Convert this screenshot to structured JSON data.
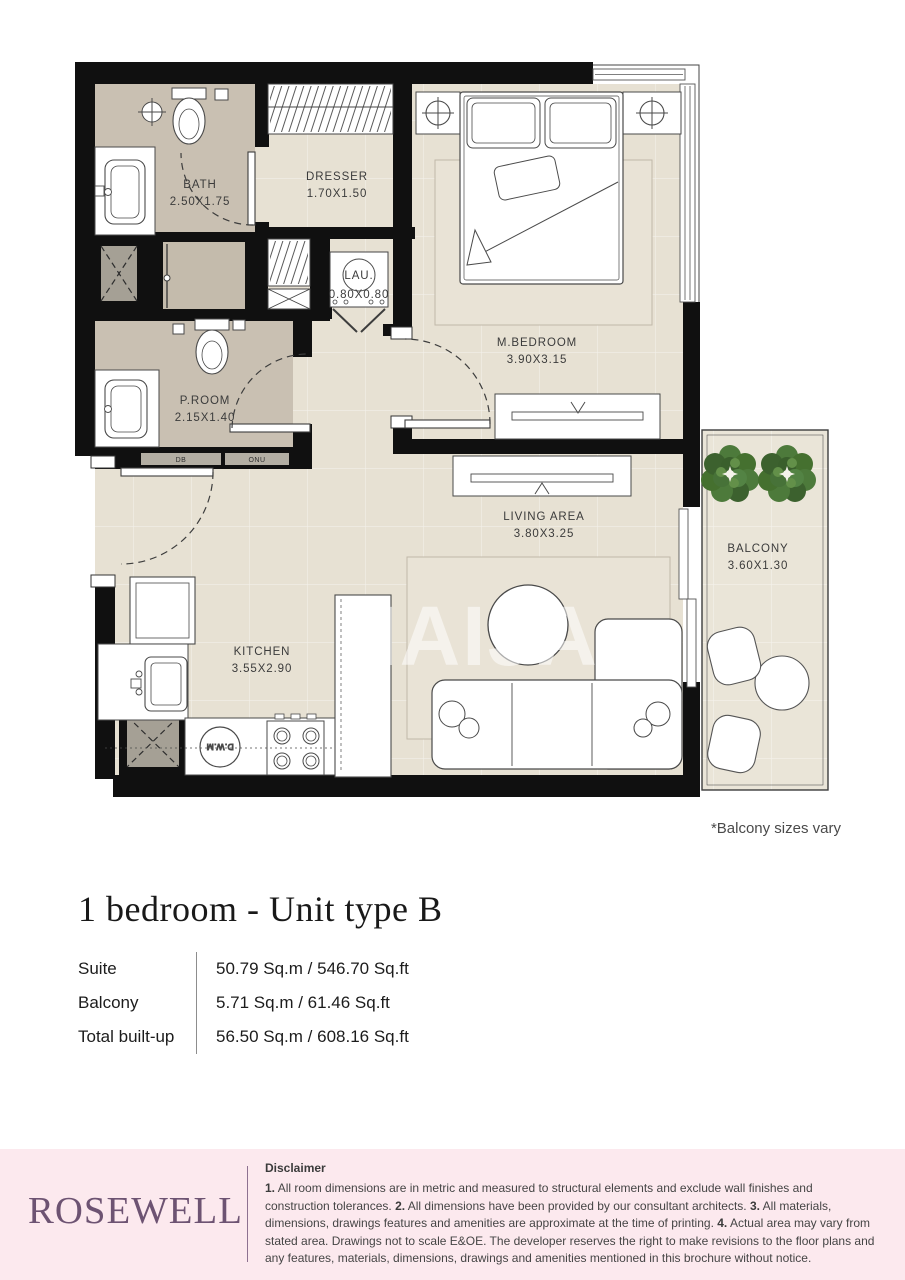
{
  "floor_plan": {
    "watermark": "HAIJA",
    "note": "*Balcony sizes vary",
    "rooms": [
      {
        "id": "bath",
        "name": "BATH",
        "dims": "2.50X1.75"
      },
      {
        "id": "dresser",
        "name": "DRESSER",
        "dims": "1.70X1.50"
      },
      {
        "id": "laundry",
        "name": "LAU.",
        "dims": "0.80X0.80"
      },
      {
        "id": "master_bedroom",
        "name": "M.BEDROOM",
        "dims": "3.90X3.15"
      },
      {
        "id": "powder_room",
        "name": "P.ROOM",
        "dims": "2.15X1.40"
      },
      {
        "id": "living_area",
        "name": "LIVING AREA",
        "dims": "3.80X3.25"
      },
      {
        "id": "balcony",
        "name": "BALCONY",
        "dims": "3.60X1.30"
      },
      {
        "id": "kitchen",
        "name": "KITCHEN",
        "dims": "3.55X2.90"
      }
    ],
    "wall_labels": {
      "db": "DB",
      "onu": "ONU"
    },
    "appliance_labels": {
      "dwm": "D.W.M"
    },
    "colors": {
      "wall": "#101010",
      "floor": "#e7e1d3",
      "wet_floor": "#c9c0b2",
      "balcony_floor": "#eae5d8",
      "rug": "#e9e3d6",
      "plant_green": "#4d7a3b"
    }
  },
  "details": {
    "title": "1 bedroom - Unit type B",
    "area_table": {
      "rows": [
        {
          "label": "Suite",
          "value": "50.79 Sq.m / 546.70 Sq.ft"
        },
        {
          "label": "Balcony",
          "value": "5.71 Sq.m / 61.46 Sq.ft"
        },
        {
          "label": "Total built-up",
          "value": "56.50 Sq.m / 608.16 Sq.ft"
        }
      ]
    }
  },
  "footer": {
    "brand": "ROSEWELL",
    "disclaimer": {
      "heading": "Disclaimer",
      "segments": [
        "1.",
        " All room dimensions are in metric and measured to structural elements and exclude wall finishes and construction tolerances. ",
        "2.",
        " All dimensions have been provided by our consultant architects. ",
        "3.",
        " All materials, dimensions, drawings features and amenities are approximate at the time of printing. ",
        "4.",
        " Actual area may vary from stated area. Drawings not to scale E&OE. The developer reserves the right to make revisions to the floor plans and any features, materials, dimensions, drawings and amenities mentioned in this brochure without notice."
      ]
    }
  }
}
